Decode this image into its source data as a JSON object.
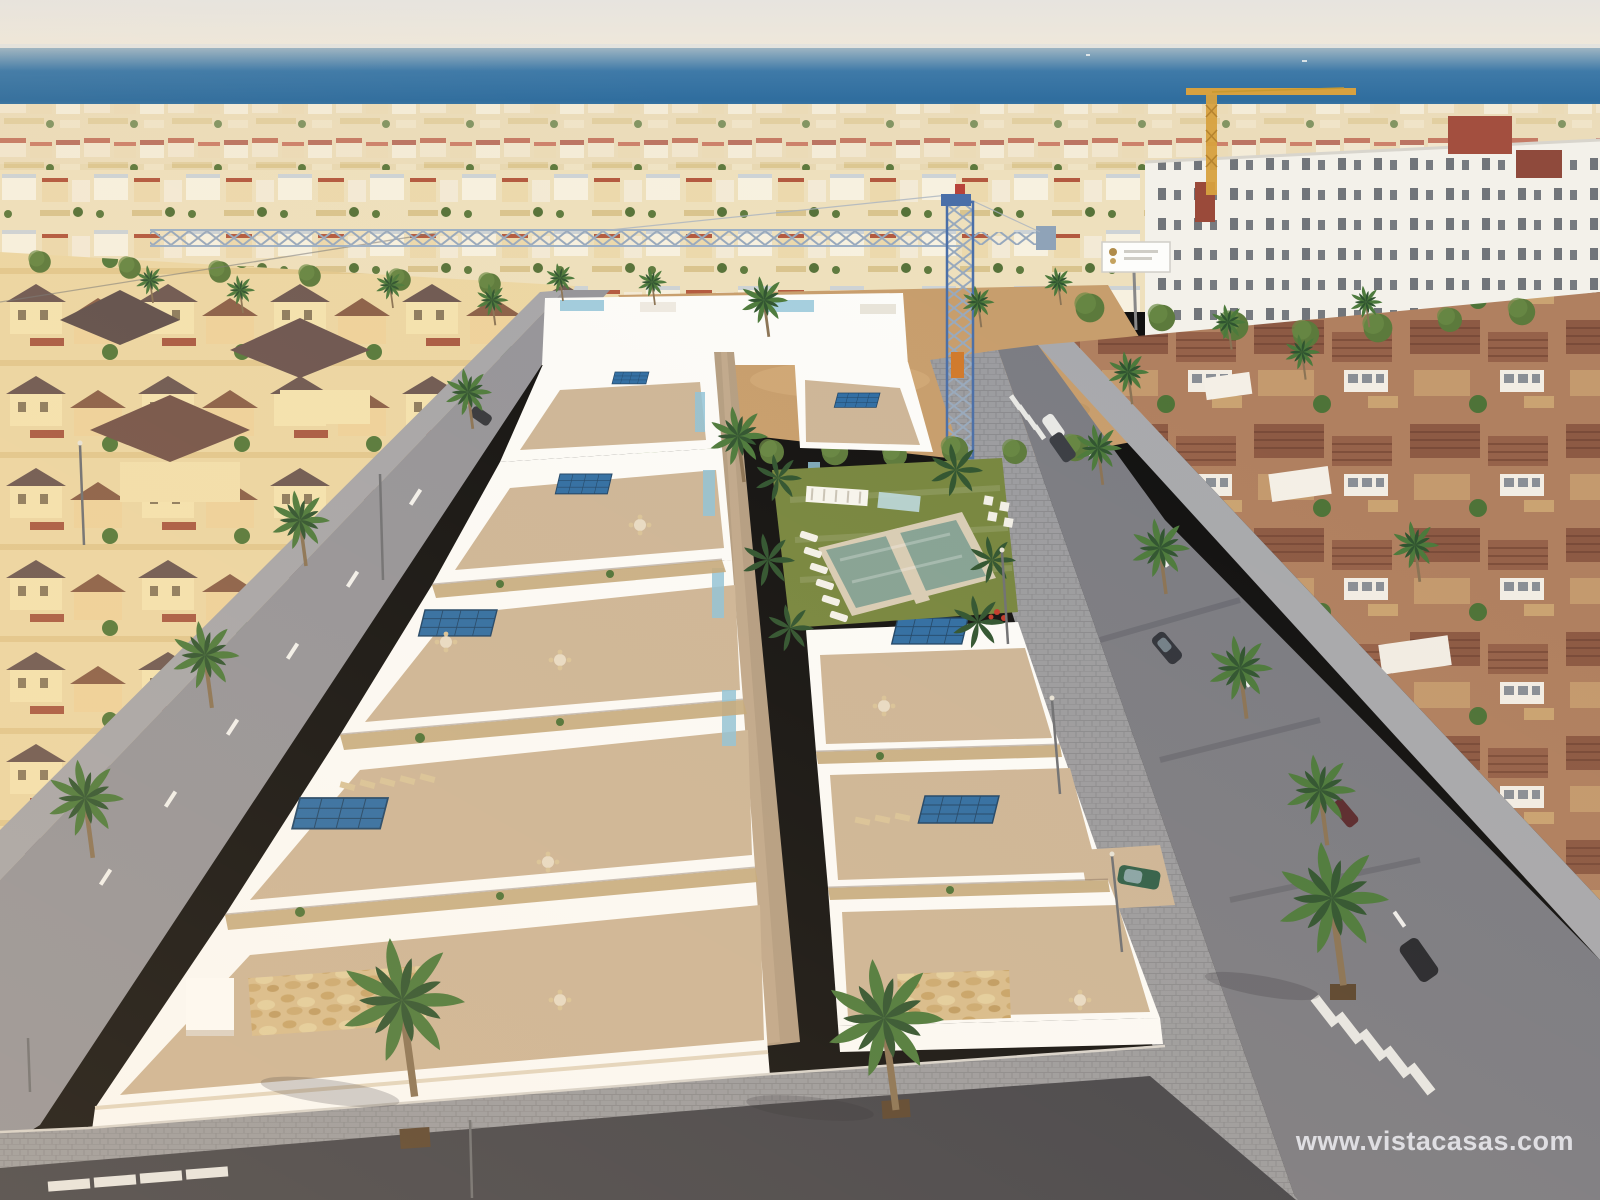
{
  "watermark": {
    "text": "www.vistacasas.com"
  },
  "palette": {
    "sky": "#e9e6e0",
    "sea_deep": "#2f6d9e",
    "sea_light": "#9db4c2",
    "town_cream": "#ecdfc0",
    "sand": "#c79e6d",
    "lawn": "#76863f",
    "pool": "#85a295",
    "road_dark": "#43444b",
    "road_mid": "#7b7c83",
    "road_light": "#94949a",
    "sidewalk": "#9b9ca0",
    "white_sun": "#fcfcfa",
    "white_shade": "#dcd3c7",
    "terrace": "#cdb698",
    "walkway": "#b49e83",
    "stone": "#d8bd8d",
    "solar": "#2e6da4",
    "glass": "#8fc3d8",
    "palm_mid": "#4c7a3c",
    "palm_dark": "#2f5430",
    "trunk": "#8a7355",
    "roof_terracotta": "#96624a",
    "villa_gold": "#ecd7a4",
    "crane_blue": "#4a6fa8",
    "crane_yellow": "#d7a13f",
    "watermark": "#e6e6ea"
  }
}
